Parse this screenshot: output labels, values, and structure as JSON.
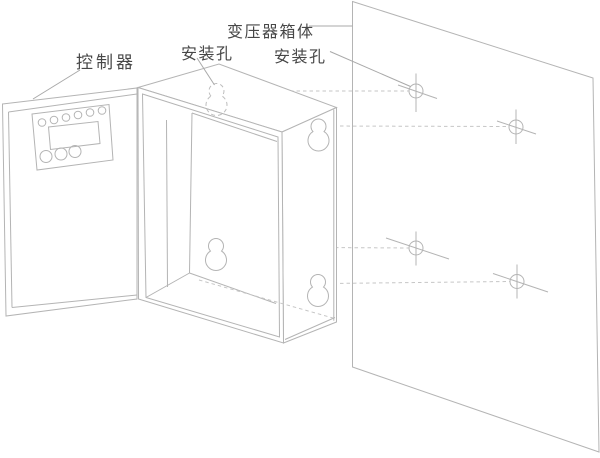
{
  "figure": {
    "kind": "technical installation line drawing",
    "background_color": "#ffffff",
    "line_color": "#b4b4b4",
    "dashed_line_color": "#c6c6c6",
    "leader_line_color": "#a9a9a9",
    "text_color": "#474747",
    "labels": {
      "controller": "控制器",
      "mounting_hole_left": "安装孔",
      "transformer_body": "变压器箱体",
      "mounting_hole_right": "安装孔"
    }
  }
}
